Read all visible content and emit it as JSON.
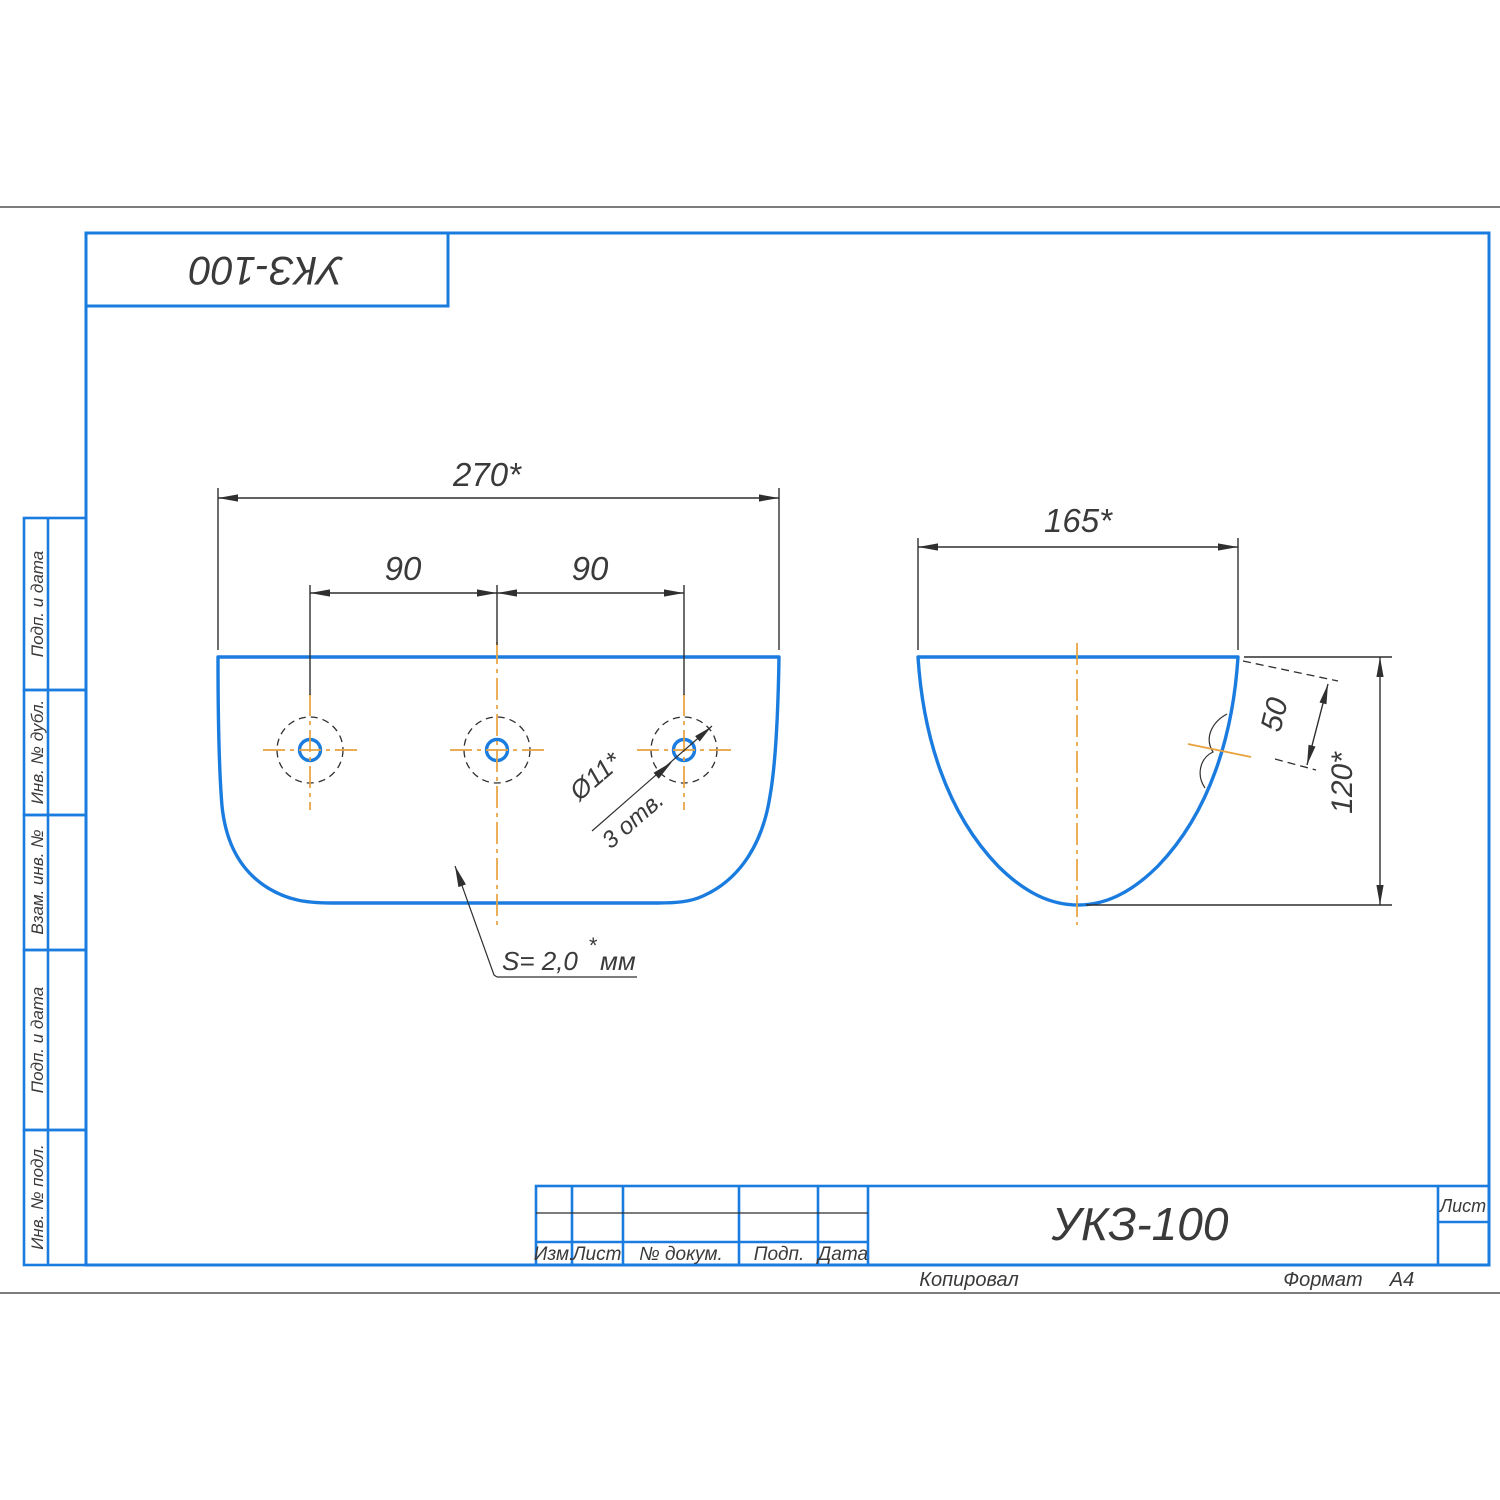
{
  "colors": {
    "outline_blue": "#1b7ce0",
    "centerline_orange": "#e8a13c",
    "line_dark": "#2f2f2f",
    "text_dark": "#3a3a3a",
    "background": "#ffffff"
  },
  "top_stamp": {
    "designation_rotated": "УКЗ-100"
  },
  "side_column": {
    "labels": [
      "Подп. и дата",
      "Инв. № дубл.",
      "Взам. инв. №",
      "Подп. и дата",
      "Инв. № подл."
    ]
  },
  "front_view": {
    "width_dim": "270*",
    "pitch_left_dim": "90",
    "pitch_right_dim": "90",
    "holes_dia_note": "Ø11*",
    "holes_count_note": "3 отв.",
    "thickness_value": "S= 2,0",
    "thickness_star": "*",
    "thickness_unit": "мм"
  },
  "side_view": {
    "width_dim": "165*",
    "flange_dim": "50",
    "height_dim": "120*"
  },
  "title_block": {
    "col_izm": "Изм.",
    "col_list": "Лист",
    "col_doc": "№ докум.",
    "col_podp": "Подп.",
    "col_data": "Дата",
    "designation": "УКЗ-100",
    "sheet_cell_label": "Лист",
    "copied_label": "Копировал",
    "format_label": "Формат",
    "format_value": "А4"
  }
}
